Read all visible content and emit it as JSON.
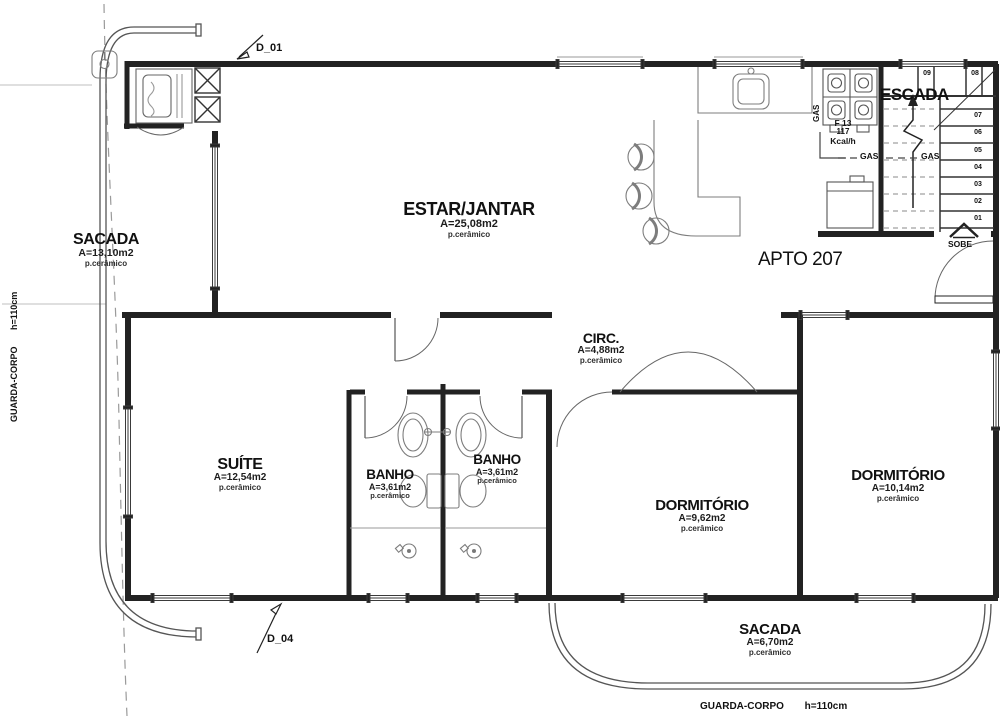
{
  "drawing": {
    "apartment": "APTO 207",
    "rooms": {
      "sacada_left": {
        "name": "SACADA",
        "area": "A=13,10m2",
        "floor": "p.cerâmico"
      },
      "estar_jantar": {
        "name": "ESTAR/JANTAR",
        "area": "A=25,08m2",
        "floor": "p.cerâmico"
      },
      "circ": {
        "name": "CIRC.",
        "area": "A=4,88m2",
        "floor": "p.cerâmico"
      },
      "suite": {
        "name": "SUÍTE",
        "area": "A=12,54m2",
        "floor": "p.cerâmico"
      },
      "banho_1": {
        "name": "BANHO",
        "area": "A=3,61m2",
        "floor": "p.cerâmico"
      },
      "banho_2": {
        "name": "BANHO",
        "area": "A=3,61m2",
        "floor": "p.cerâmico"
      },
      "dormitorio_1": {
        "name": "DORMITÓRIO",
        "area": "A=9,62m2",
        "floor": "p.cerâmico"
      },
      "dormitorio_2": {
        "name": "DORMITÓRIO",
        "area": "A=10,14m2",
        "floor": "p.cerâmico"
      },
      "sacada_bottom": {
        "name": "SACADA",
        "area": "A=6,70m2",
        "floor": "p.cerâmico"
      }
    },
    "stairs": {
      "label": "ESCADA",
      "direction": "SOBE",
      "steps": [
        "01",
        "02",
        "03",
        "04",
        "05",
        "06",
        "07",
        "08",
        "09"
      ]
    },
    "doors": {
      "d01": "D_01",
      "d04": "D_04"
    },
    "gas": {
      "riser": "GAS",
      "line_left": "GAS",
      "line_right": "GAS",
      "heater_model": "F 13",
      "heater_power": "117",
      "heater_unit": "Kcal/h"
    },
    "guardrail": {
      "label": "GUARDA-CORPO",
      "height": "h=110cm"
    }
  }
}
